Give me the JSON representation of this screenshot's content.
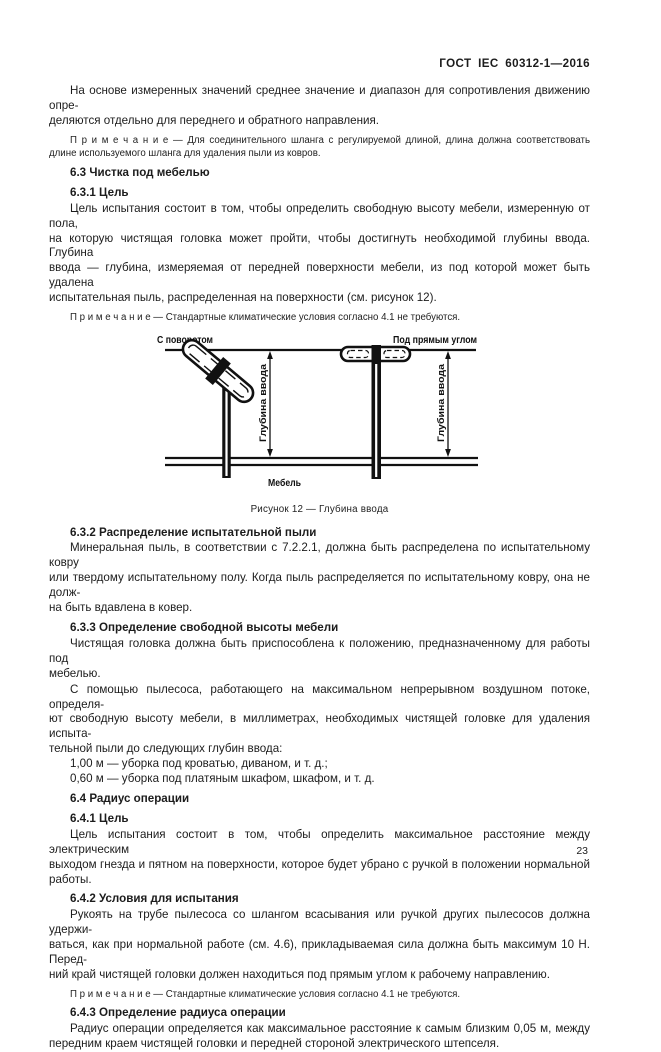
{
  "page": {
    "header": "ГОСТ IEC 60312-1—2016",
    "page_number": "23"
  },
  "content_before_figure": [
    {
      "type": "p",
      "name": "paragraph-resistance",
      "lines": [
        "На основе измеренных значений среднее значение и диапазон для сопротивления движению опре-",
        "деляются отдельно для переднего и обратного направления."
      ]
    },
    {
      "type": "note",
      "name": "note-hose-length",
      "lines": [
        "П р и м е ч а н и е — Для соединительного шланга с регулируемой длиной, длина должна соответствовать",
        "длине используемого шланга для удаления пыли из ковров."
      ]
    },
    {
      "type": "h",
      "name": "heading-6-3",
      "text": "6.3 Чистка под мебелью"
    },
    {
      "type": "h",
      "name": "heading-6-3-1",
      "text": "6.3.1 Цель"
    },
    {
      "type": "p",
      "name": "paragraph-goal-6-3-1",
      "lines": [
        "Цель испытания состоит в том, чтобы определить свободную высоту мебели, измеренную от пола,",
        "на которую чистящая головка может пройти, чтобы достигнуть необходимой глубины ввода. Глубина",
        "ввода — глубина, измеряемая от передней поверхности мебели, из под которой может быть удалена",
        "испытательная пыль, распределенная на поверхности (см. рисунок 12)."
      ]
    },
    {
      "type": "note",
      "name": "note-climate-1",
      "lines": [
        "П р и м е ч а н и е — Стандартные климатические условия согласно 4.1 не требуются."
      ]
    }
  ],
  "figure": {
    "label_with_turn": "С поворотом",
    "label_right_angle": "Под прямым углом",
    "dim_label": "Глубина ввода",
    "furniture_label": "Мебель",
    "caption": "Рисунок 12 — Глубина ввода"
  },
  "content_after_figure": [
    {
      "type": "h",
      "name": "heading-6-3-2",
      "text": "6.3.2 Распределение испытательной пыли"
    },
    {
      "type": "p",
      "name": "paragraph-dust-distribution",
      "lines": [
        "Минеральная пыль, в соответствии с 7.2.2.1, должна быть распределена по испытательному ковру",
        "или твердому испытательному полу. Когда пыль распределяется по испытательному ковру, она не долж-",
        "на быть вдавлена в ковер."
      ]
    },
    {
      "type": "h",
      "name": "heading-6-3-3",
      "text": "6.3.3 Определение свободной высоты мебели"
    },
    {
      "type": "p",
      "name": "paragraph-head-position",
      "lines": [
        "Чистящая головка должна быть приспособлена к положению, предназначенному для работы под",
        "мебелью."
      ]
    },
    {
      "type": "p",
      "name": "paragraph-free-height",
      "lines": [
        "С помощью пылесоса, работающего на максимальном непрерывном воздушном потоке, определя-",
        "ют свободную высоту мебели, в миллиметрах, необходимых чистящей головке для удаления испыта-",
        "тельной пыли до следующих глубин ввода:"
      ]
    },
    {
      "type": "li",
      "name": "list-insertion-depths",
      "lines": [
        "1,00 м — уборка под кроватью, диваном, и т. д.;",
        "0,60 м — уборка под платяным шкафом, шкафом, и т. д."
      ]
    },
    {
      "type": "h",
      "name": "heading-6-4",
      "text": "6.4 Радиус операции"
    },
    {
      "type": "h",
      "name": "heading-6-4-1",
      "text": "6.4.1 Цель"
    },
    {
      "type": "p",
      "name": "paragraph-goal-6-4-1",
      "lines": [
        "Цель испытания состоит в том, чтобы определить максимальное расстояние между электрическим",
        "выходом гнезда и пятном на поверхности, которое будет убрано с ручкой в положении нормальной",
        "работы."
      ]
    },
    {
      "type": "h",
      "name": "heading-6-4-2",
      "text": "6.4.2 Условия для испытания"
    },
    {
      "type": "p",
      "name": "paragraph-test-conditions",
      "lines": [
        "Рукоять на трубе пылесоса со шлангом всасывания или ручкой других пылесосов должна удержи-",
        "ваться, как при нормальной работе (см. 4.6), прикладываемая сила должна быть максимум 10 Н. Перед-",
        "ний край чистящей головки должен находиться под прямым углом к рабочему направлению."
      ]
    },
    {
      "type": "note",
      "name": "note-climate-2",
      "lines": [
        "П р и м е ч а н и е — Стандартные климатические условия согласно 4.1 не требуются."
      ]
    },
    {
      "type": "h",
      "name": "heading-6-4-3",
      "text": "6.4.3 Определение радиуса операции"
    },
    {
      "type": "p",
      "name": "paragraph-radius-definition",
      "lines": [
        "Радиус операции определяется как максимальное расстояние к самым близким 0,05 м, между",
        "передним краем чистящей головки и передней стороной электрического штепселя."
      ]
    }
  ]
}
